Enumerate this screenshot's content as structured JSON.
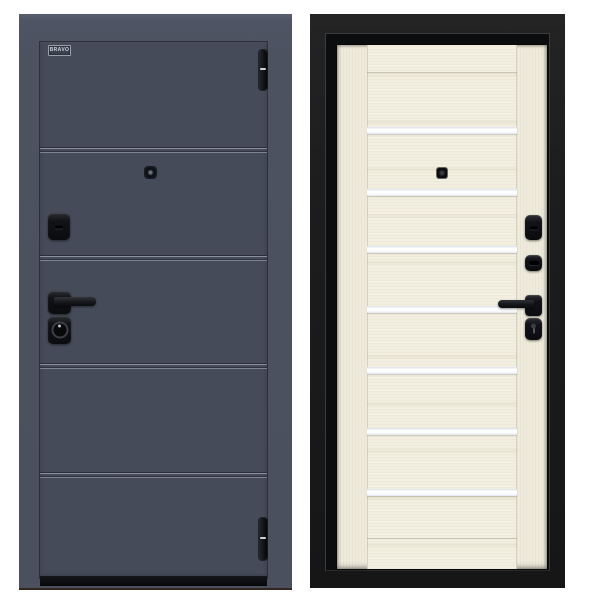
{
  "scene": {
    "background_color": "#ffffff",
    "subject": "Steel entrance door, exterior and interior views side by side"
  },
  "exterior_door": {
    "brand_label": "BRAVO",
    "leaf_color": "#454b59",
    "frame_color": "#4c5261",
    "threshold_color": "#0a0b0e",
    "hardware_color": "#121317",
    "groove_count": 4,
    "groove_y": [
      105,
      213,
      321,
      430
    ],
    "hinge_count": 2
  },
  "interior_door": {
    "leaf_color": "#efebdc",
    "frame_color": "#161617",
    "glass_strip_color": "#fbfcfe",
    "hardware_color": "#15161a",
    "glass_strip_count": 7,
    "glass_strip_y": [
      82,
      144,
      201,
      261,
      322,
      383,
      444
    ]
  }
}
